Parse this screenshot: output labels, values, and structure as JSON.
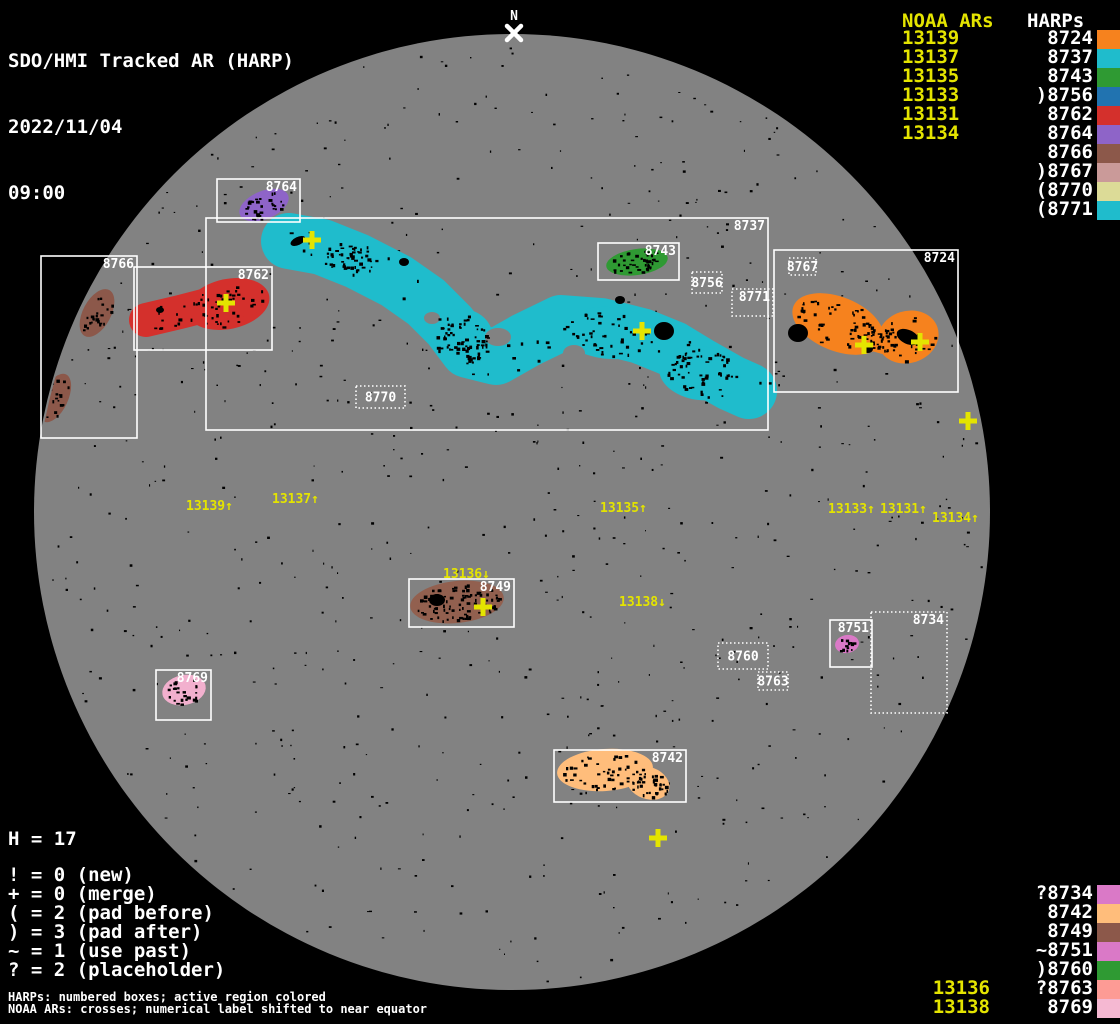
{
  "title": {
    "line1": "SDO/HMI Tracked AR (HARP)",
    "date": "2022/11/04",
    "time": "09:00"
  },
  "north_marker": {
    "label": "N",
    "x": 514,
    "y": 33
  },
  "colors": {
    "yellow": "#E4E400",
    "disk_gray": "#828282",
    "background": "#000000",
    "box_white": "#FFFFFF"
  },
  "disk": {
    "cx": 512,
    "cy": 512,
    "r": 478
  },
  "legend_top_right": {
    "noaa_header": "NOAA ARs",
    "harps_header": "HARPs",
    "rows": [
      {
        "noaa": "13139",
        "harp": "8724",
        "color": "#F6821E"
      },
      {
        "noaa": "13137",
        "harp": "8737",
        "color": "#1FBCCC"
      },
      {
        "noaa": "13135",
        "harp": "8743",
        "color": "#2F9A33"
      },
      {
        "noaa": "13133",
        "harp": ")8756",
        "color": "#2173B0"
      },
      {
        "noaa": "13131",
        "harp": "8762",
        "color": "#D4302C"
      },
      {
        "noaa": "13134",
        "harp": "8764",
        "color": "#8E64C8"
      },
      {
        "noaa": "",
        "harp": "8766",
        "color": "#8C584A"
      },
      {
        "noaa": "",
        "harp": ")8767",
        "color": "#CA9A99"
      },
      {
        "noaa": "",
        "harp": "(8770",
        "color": "#DCDB97"
      },
      {
        "noaa": "",
        "harp": "(8771",
        "color": "#1FBCCC"
      }
    ]
  },
  "legend_bottom_right": {
    "rows": [
      {
        "noaa": "",
        "harp": "?8734",
        "color": "#DA79C7"
      },
      {
        "noaa": "",
        "harp": "8742",
        "color": "#FFBD7B"
      },
      {
        "noaa": "",
        "harp": "8749",
        "color": "#8C584A"
      },
      {
        "noaa": "",
        "harp": "~8751",
        "color": "#DA79C7"
      },
      {
        "noaa": "",
        "harp": ")8760",
        "color": "#2F9A33"
      },
      {
        "noaa": "13136",
        "harp": "?8763",
        "color": "#FD9B95"
      },
      {
        "noaa": "13138",
        "harp": "8769",
        "color": "#F5B8D2"
      }
    ]
  },
  "stats": {
    "h_line": "H = 17",
    "lines": [
      "! = 0 (new)",
      "+ = 0 (merge)",
      "( = 2 (pad before)",
      ") = 3 (pad after)",
      "~ = 1 (use past)",
      "? = 2 (placeholder)"
    ]
  },
  "footnotes": [
    "HARPs: numbered boxes; active region colored",
    "NOAA ARs: crosses; numerical label shifted to near equator"
  ],
  "chart_data": {
    "type": "table",
    "title": "SDO/HMI Tracked AR (HARP)",
    "datetime": "2022/11/04 09:00",
    "harp_total": 17,
    "columns": [
      "NOAA AR",
      "HARP",
      "prefix_flag",
      "color"
    ],
    "rows": [
      [
        "13139",
        "8724",
        "",
        "#F6821E"
      ],
      [
        "13137",
        "8737",
        "",
        "#1FBCCC"
      ],
      [
        "13135",
        "8743",
        "",
        "#2F9A33"
      ],
      [
        "13133",
        "8756",
        ")",
        "#2173B0"
      ],
      [
        "13131",
        "8762",
        "",
        "#D4302C"
      ],
      [
        "13134",
        "8764",
        "",
        "#8E64C8"
      ],
      [
        "",
        "8766",
        "",
        "#8C584A"
      ],
      [
        "",
        "8767",
        ")",
        "#CA9A99"
      ],
      [
        "",
        "8770",
        "(",
        "#DCDB97"
      ],
      [
        "",
        "8771",
        "(",
        "#1FBCCC"
      ],
      [
        "",
        "8734",
        "?",
        "#DA79C7"
      ],
      [
        "",
        "8742",
        "",
        "#FFBD7B"
      ],
      [
        "",
        "8749",
        "",
        "#8C584A"
      ],
      [
        "",
        "8751",
        "~",
        "#DA79C7"
      ],
      [
        "",
        "8760",
        ")",
        "#2F9A33"
      ],
      [
        "13136",
        "8763",
        "?",
        "#FD9B95"
      ],
      [
        "13138",
        "8769",
        "",
        "#F5B8D2"
      ]
    ],
    "flag_counts": {
      "new": 0,
      "merge": 0,
      "pad_before": 2,
      "pad_after": 3,
      "use_past": 1,
      "placeholder": 2
    }
  },
  "harp_boxes": [
    {
      "label": "8737",
      "x": 206,
      "y": 218,
      "w": 562,
      "h": 212,
      "dotted": false,
      "lp": "tr"
    },
    {
      "label": "8764",
      "x": 217,
      "y": 179,
      "w": 83,
      "h": 43,
      "dotted": false,
      "lp": "tr"
    },
    {
      "label": "8766",
      "x": 41,
      "y": 256,
      "w": 96,
      "h": 182,
      "dotted": false,
      "lp": "tr"
    },
    {
      "label": "8762",
      "x": 134,
      "y": 267,
      "w": 138,
      "h": 83,
      "dotted": false,
      "lp": "tr"
    },
    {
      "label": "8743",
      "x": 598,
      "y": 243,
      "w": 81,
      "h": 37,
      "dotted": false,
      "lp": "tr"
    },
    {
      "label": "8756",
      "x": 692,
      "y": 272,
      "w": 30,
      "h": 21,
      "dotted": true,
      "lp": "c"
    },
    {
      "label": "8771",
      "x": 732,
      "y": 289,
      "w": 41,
      "h": 27,
      "dotted": true,
      "lp": "tr"
    },
    {
      "label": "8767",
      "x": 789,
      "y": 258,
      "w": 27,
      "h": 17,
      "dotted": true,
      "lp": "c"
    },
    {
      "label": "8724",
      "x": 774,
      "y": 250,
      "w": 184,
      "h": 142,
      "dotted": false,
      "lp": "tr"
    },
    {
      "label": "8770",
      "x": 356,
      "y": 386,
      "w": 49,
      "h": 22,
      "dotted": true,
      "lp": "c"
    },
    {
      "label": "8749",
      "x": 409,
      "y": 579,
      "w": 105,
      "h": 48,
      "dotted": false,
      "lp": "tr"
    },
    {
      "label": "8769",
      "x": 156,
      "y": 670,
      "w": 55,
      "h": 50,
      "dotted": false,
      "lp": "tr"
    },
    {
      "label": "8760",
      "x": 718,
      "y": 643,
      "w": 50,
      "h": 26,
      "dotted": true,
      "lp": "c"
    },
    {
      "label": "8763",
      "x": 758,
      "y": 672,
      "w": 30,
      "h": 18,
      "dotted": true,
      "lp": "c"
    },
    {
      "label": "8751",
      "x": 830,
      "y": 620,
      "w": 42,
      "h": 47,
      "dotted": false,
      "lp": "tr"
    },
    {
      "label": "8734",
      "x": 871,
      "y": 612,
      "w": 76,
      "h": 101,
      "dotted": true,
      "lp": "tr"
    },
    {
      "label": "8742",
      "x": 554,
      "y": 750,
      "w": 132,
      "h": 52,
      "dotted": false,
      "lp": "tr"
    }
  ],
  "regions": [
    {
      "harp": "8764",
      "color": "#8E64C8",
      "dots": 30,
      "shapes": [
        {
          "t": "e",
          "cx": 264,
          "cy": 205,
          "rx": 26,
          "ry": 14,
          "rot": -22
        }
      ]
    },
    {
      "harp": "8766",
      "color": "#8C584A",
      "dots": 40,
      "shapes": [
        {
          "t": "e",
          "cx": 97,
          "cy": 313,
          "rx": 14,
          "ry": 26,
          "rot": 28
        },
        {
          "t": "e",
          "cx": 55,
          "cy": 398,
          "rx": 13,
          "ry": 26,
          "rot": 25
        }
      ]
    },
    {
      "harp": "8762",
      "color": "#D4302C",
      "dots": 60,
      "shapes": [
        {
          "t": "e",
          "cx": 228,
          "cy": 304,
          "rx": 42,
          "ry": 25,
          "rot": -12
        },
        {
          "t": "k",
          "pts": [
            [
              146,
              320
            ],
            [
              180,
              312
            ],
            [
              215,
              303
            ],
            [
              246,
              299
            ]
          ],
          "w": 34
        }
      ]
    },
    {
      "harp": "8737",
      "color": "#1FBCCC",
      "dots": 260,
      "shapes": [
        {
          "t": "k",
          "pts": [
            [
              289,
              241
            ],
            [
              322,
              247
            ],
            [
              357,
              261
            ],
            [
              396,
              281
            ],
            [
              426,
              302
            ],
            [
              450,
              326
            ],
            [
              468,
              350
            ],
            [
              496,
              357
            ],
            [
              526,
              340
            ],
            [
              561,
              323
            ],
            [
              601,
              326
            ],
            [
              641,
              336
            ],
            [
              673,
              349
            ],
            [
              701,
              366
            ],
            [
              731,
              383
            ],
            [
              749,
              391
            ]
          ],
          "w": 56
        },
        {
          "t": "e",
          "cx": 350,
          "cy": 259,
          "rx": 30,
          "ry": 17,
          "rot": 14
        },
        {
          "t": "e",
          "cx": 462,
          "cy": 338,
          "rx": 31,
          "ry": 29,
          "rot": 0
        },
        {
          "t": "e",
          "cx": 610,
          "cy": 333,
          "rx": 48,
          "ry": 26,
          "rot": 4
        },
        {
          "t": "e",
          "cx": 700,
          "cy": 373,
          "rx": 41,
          "ry": 27,
          "rot": 8
        }
      ],
      "holes": [
        {
          "cx": 498,
          "cy": 337,
          "rx": 13,
          "ry": 9
        },
        {
          "cx": 574,
          "cy": 353,
          "rx": 11,
          "ry": 8
        },
        {
          "cx": 432,
          "cy": 318,
          "rx": 8,
          "ry": 6
        }
      ]
    },
    {
      "harp": "8743",
      "color": "#2F9A33",
      "dots": 45,
      "shapes": [
        {
          "t": "e",
          "cx": 637,
          "cy": 262,
          "rx": 31,
          "ry": 13,
          "rot": -8
        }
      ]
    },
    {
      "harp": "8724",
      "color": "#F6821E",
      "dots": 110,
      "shapes": [
        {
          "t": "e",
          "cx": 838,
          "cy": 324,
          "rx": 48,
          "ry": 27,
          "rot": 22
        },
        {
          "t": "e",
          "cx": 908,
          "cy": 337,
          "rx": 31,
          "ry": 26,
          "rot": -18
        },
        {
          "t": "k",
          "pts": [
            [
              855,
              333
            ],
            [
              895,
              344
            ]
          ],
          "w": 26
        }
      ]
    },
    {
      "harp": "8749",
      "color": "#92604F",
      "dots": 90,
      "shapes": [
        {
          "t": "e",
          "cx": 457,
          "cy": 602,
          "rx": 47,
          "ry": 21,
          "rot": -6
        }
      ]
    },
    {
      "harp": "8769",
      "color": "#F2B0CE",
      "dots": 25,
      "shapes": [
        {
          "t": "e",
          "cx": 184,
          "cy": 690,
          "rx": 22,
          "ry": 15,
          "rot": -12
        }
      ]
    },
    {
      "harp": "8751",
      "color": "#DA79C7",
      "dots": 12,
      "shapes": [
        {
          "t": "e",
          "cx": 847,
          "cy": 644,
          "rx": 12,
          "ry": 9,
          "rot": -10
        }
      ]
    },
    {
      "harp": "8742",
      "color": "#FFBD7B",
      "dots": 80,
      "shapes": [
        {
          "t": "e",
          "cx": 605,
          "cy": 770,
          "rx": 48,
          "ry": 21,
          "rot": -4
        },
        {
          "t": "e",
          "cx": 648,
          "cy": 783,
          "rx": 22,
          "ry": 16,
          "rot": 20
        }
      ]
    }
  ],
  "black_spots": [
    {
      "cx": 298,
      "cy": 241,
      "rx": 8,
      "ry": 4,
      "rot": -25
    },
    {
      "cx": 404,
      "cy": 262,
      "rx": 5,
      "ry": 4,
      "rot": 0
    },
    {
      "cx": 664,
      "cy": 331,
      "rx": 10,
      "ry": 9,
      "rot": 0
    },
    {
      "cx": 620,
      "cy": 300,
      "rx": 5,
      "ry": 4,
      "rot": 0
    },
    {
      "cx": 798,
      "cy": 333,
      "rx": 10,
      "ry": 9,
      "rot": 0
    },
    {
      "cx": 908,
      "cy": 337,
      "rx": 12,
      "ry": 7,
      "rot": 25
    },
    {
      "cx": 868,
      "cy": 349,
      "rx": 5,
      "ry": 4,
      "rot": 0
    },
    {
      "cx": 437,
      "cy": 600,
      "rx": 8,
      "ry": 6,
      "rot": 0
    },
    {
      "cx": 160,
      "cy": 310,
      "rx": 4,
      "ry": 3,
      "rot": 0
    }
  ],
  "noaa_crosses": [
    {
      "x": 312,
      "y": 240
    },
    {
      "x": 226,
      "y": 303
    },
    {
      "x": 642,
      "y": 331
    },
    {
      "x": 864,
      "y": 345
    },
    {
      "x": 920,
      "y": 342
    },
    {
      "x": 968,
      "y": 421
    },
    {
      "x": 483,
      "y": 607
    },
    {
      "x": 658,
      "y": 838
    }
  ],
  "noaa_labels": [
    {
      "text": "13139",
      "arrow": "↑",
      "x": 186,
      "y": 510
    },
    {
      "text": "13137",
      "arrow": "↑",
      "x": 272,
      "y": 503
    },
    {
      "text": "13135",
      "arrow": "↑",
      "x": 600,
      "y": 512
    },
    {
      "text": "13133",
      "arrow": "↑",
      "x": 828,
      "y": 513
    },
    {
      "text": "13131",
      "arrow": "↑",
      "x": 880,
      "y": 513
    },
    {
      "text": "13134",
      "arrow": "↑",
      "x": 932,
      "y": 522
    },
    {
      "text": "13136",
      "arrow": "↓",
      "x": 443,
      "y": 578
    },
    {
      "text": "13138",
      "arrow": "↓",
      "x": 619,
      "y": 606
    }
  ]
}
